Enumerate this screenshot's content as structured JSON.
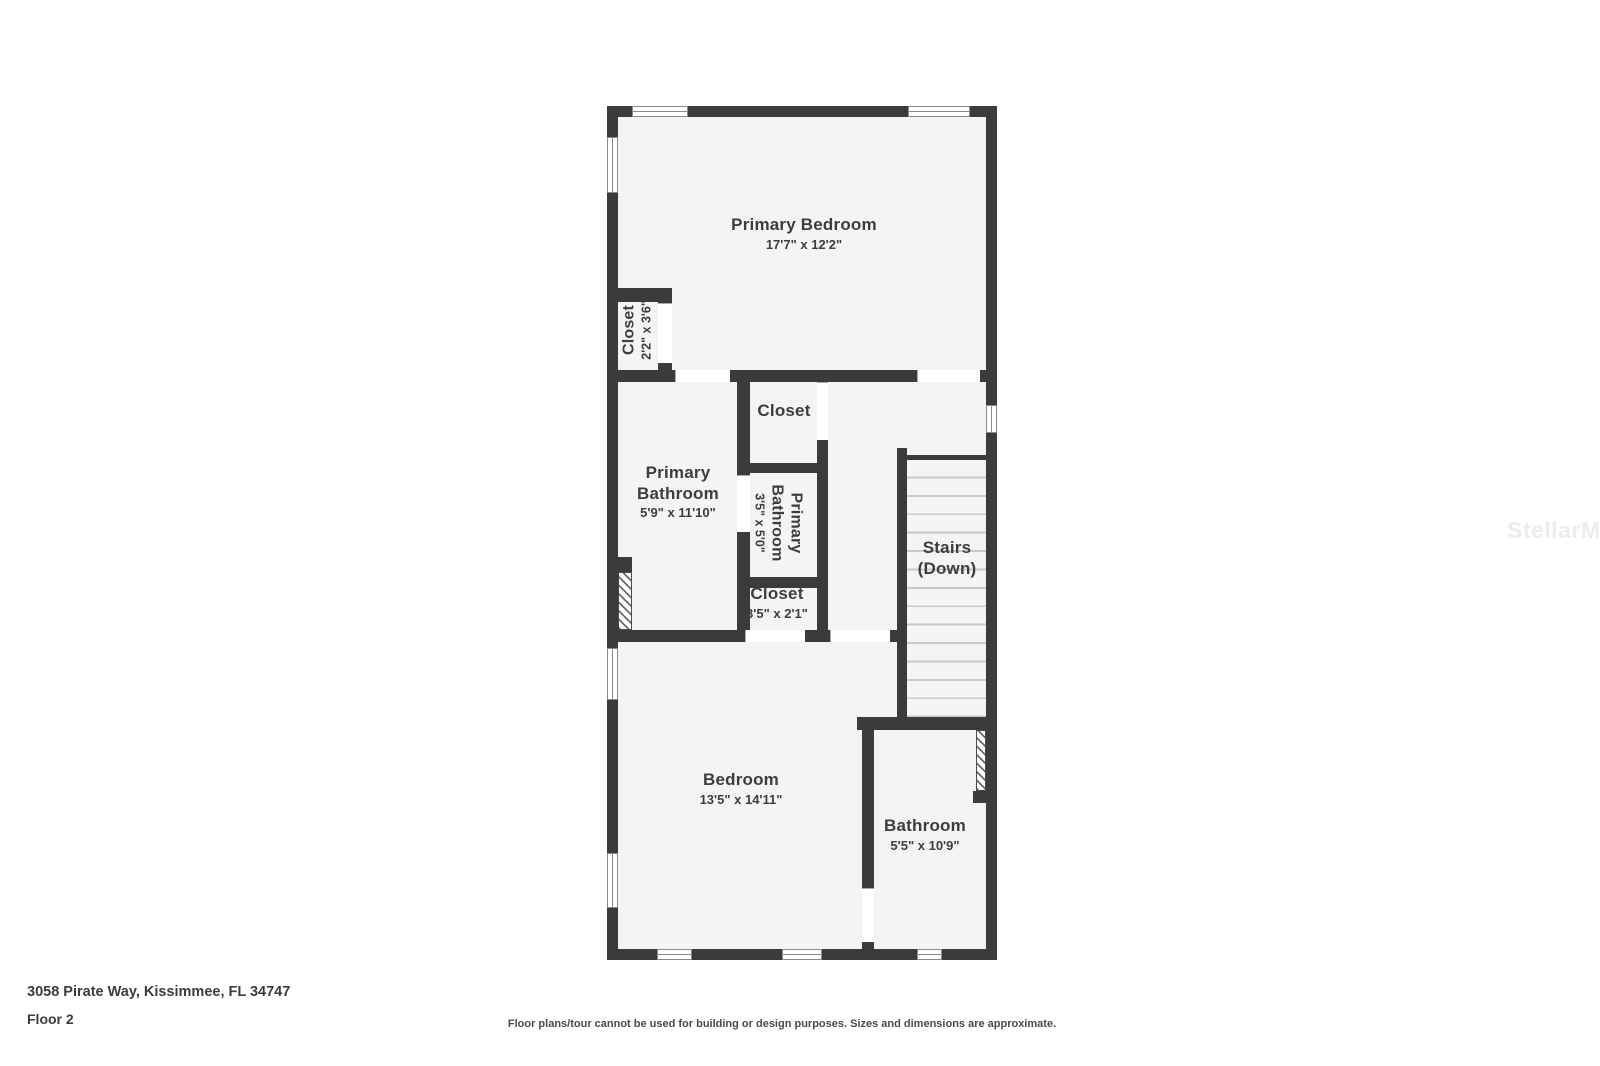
{
  "meta": {
    "address": "3058 Pirate Way, Kissimmee, FL 34747",
    "floor_label": "Floor 2",
    "disclaimer": "Floor plans/tour cannot be used for building or design purposes. Sizes and dimensions are approximate.",
    "watermark": "StellarMLS"
  },
  "colors": {
    "wall": "#3b3b3b",
    "room_fill": "#f4f4f5",
    "label_text": "#3d3d3d",
    "stair_tread": "#c9c9c9",
    "window_frame": "#8a8a8a",
    "watermark": "#ececec",
    "background": "#ffffff"
  },
  "rooms": {
    "primary_bedroom": {
      "name": "Primary Bedroom",
      "dims": "17'7\" x 12'2\""
    },
    "closet_primary": {
      "name": "Closet",
      "dims": "2'2\" x 3'6\""
    },
    "primary_bathroom": {
      "name": "Primary Bathroom",
      "dims": "5'9\" x 11'10\""
    },
    "closet_hall": {
      "name": "Closet"
    },
    "primary_bathroom_small": {
      "name": "Primary Bathroom",
      "dims": "3'5\" x 5'0\""
    },
    "closet_small": {
      "name": "Closet",
      "dims": "3'5\" x 2'1\""
    },
    "stairs": {
      "name": "Stairs",
      "sub": "(Down)"
    },
    "bedroom": {
      "name": "Bedroom",
      "dims": "13'5\" x 14'11\""
    },
    "bathroom": {
      "name": "Bathroom",
      "dims": "5'5\" x 10'9\""
    }
  }
}
